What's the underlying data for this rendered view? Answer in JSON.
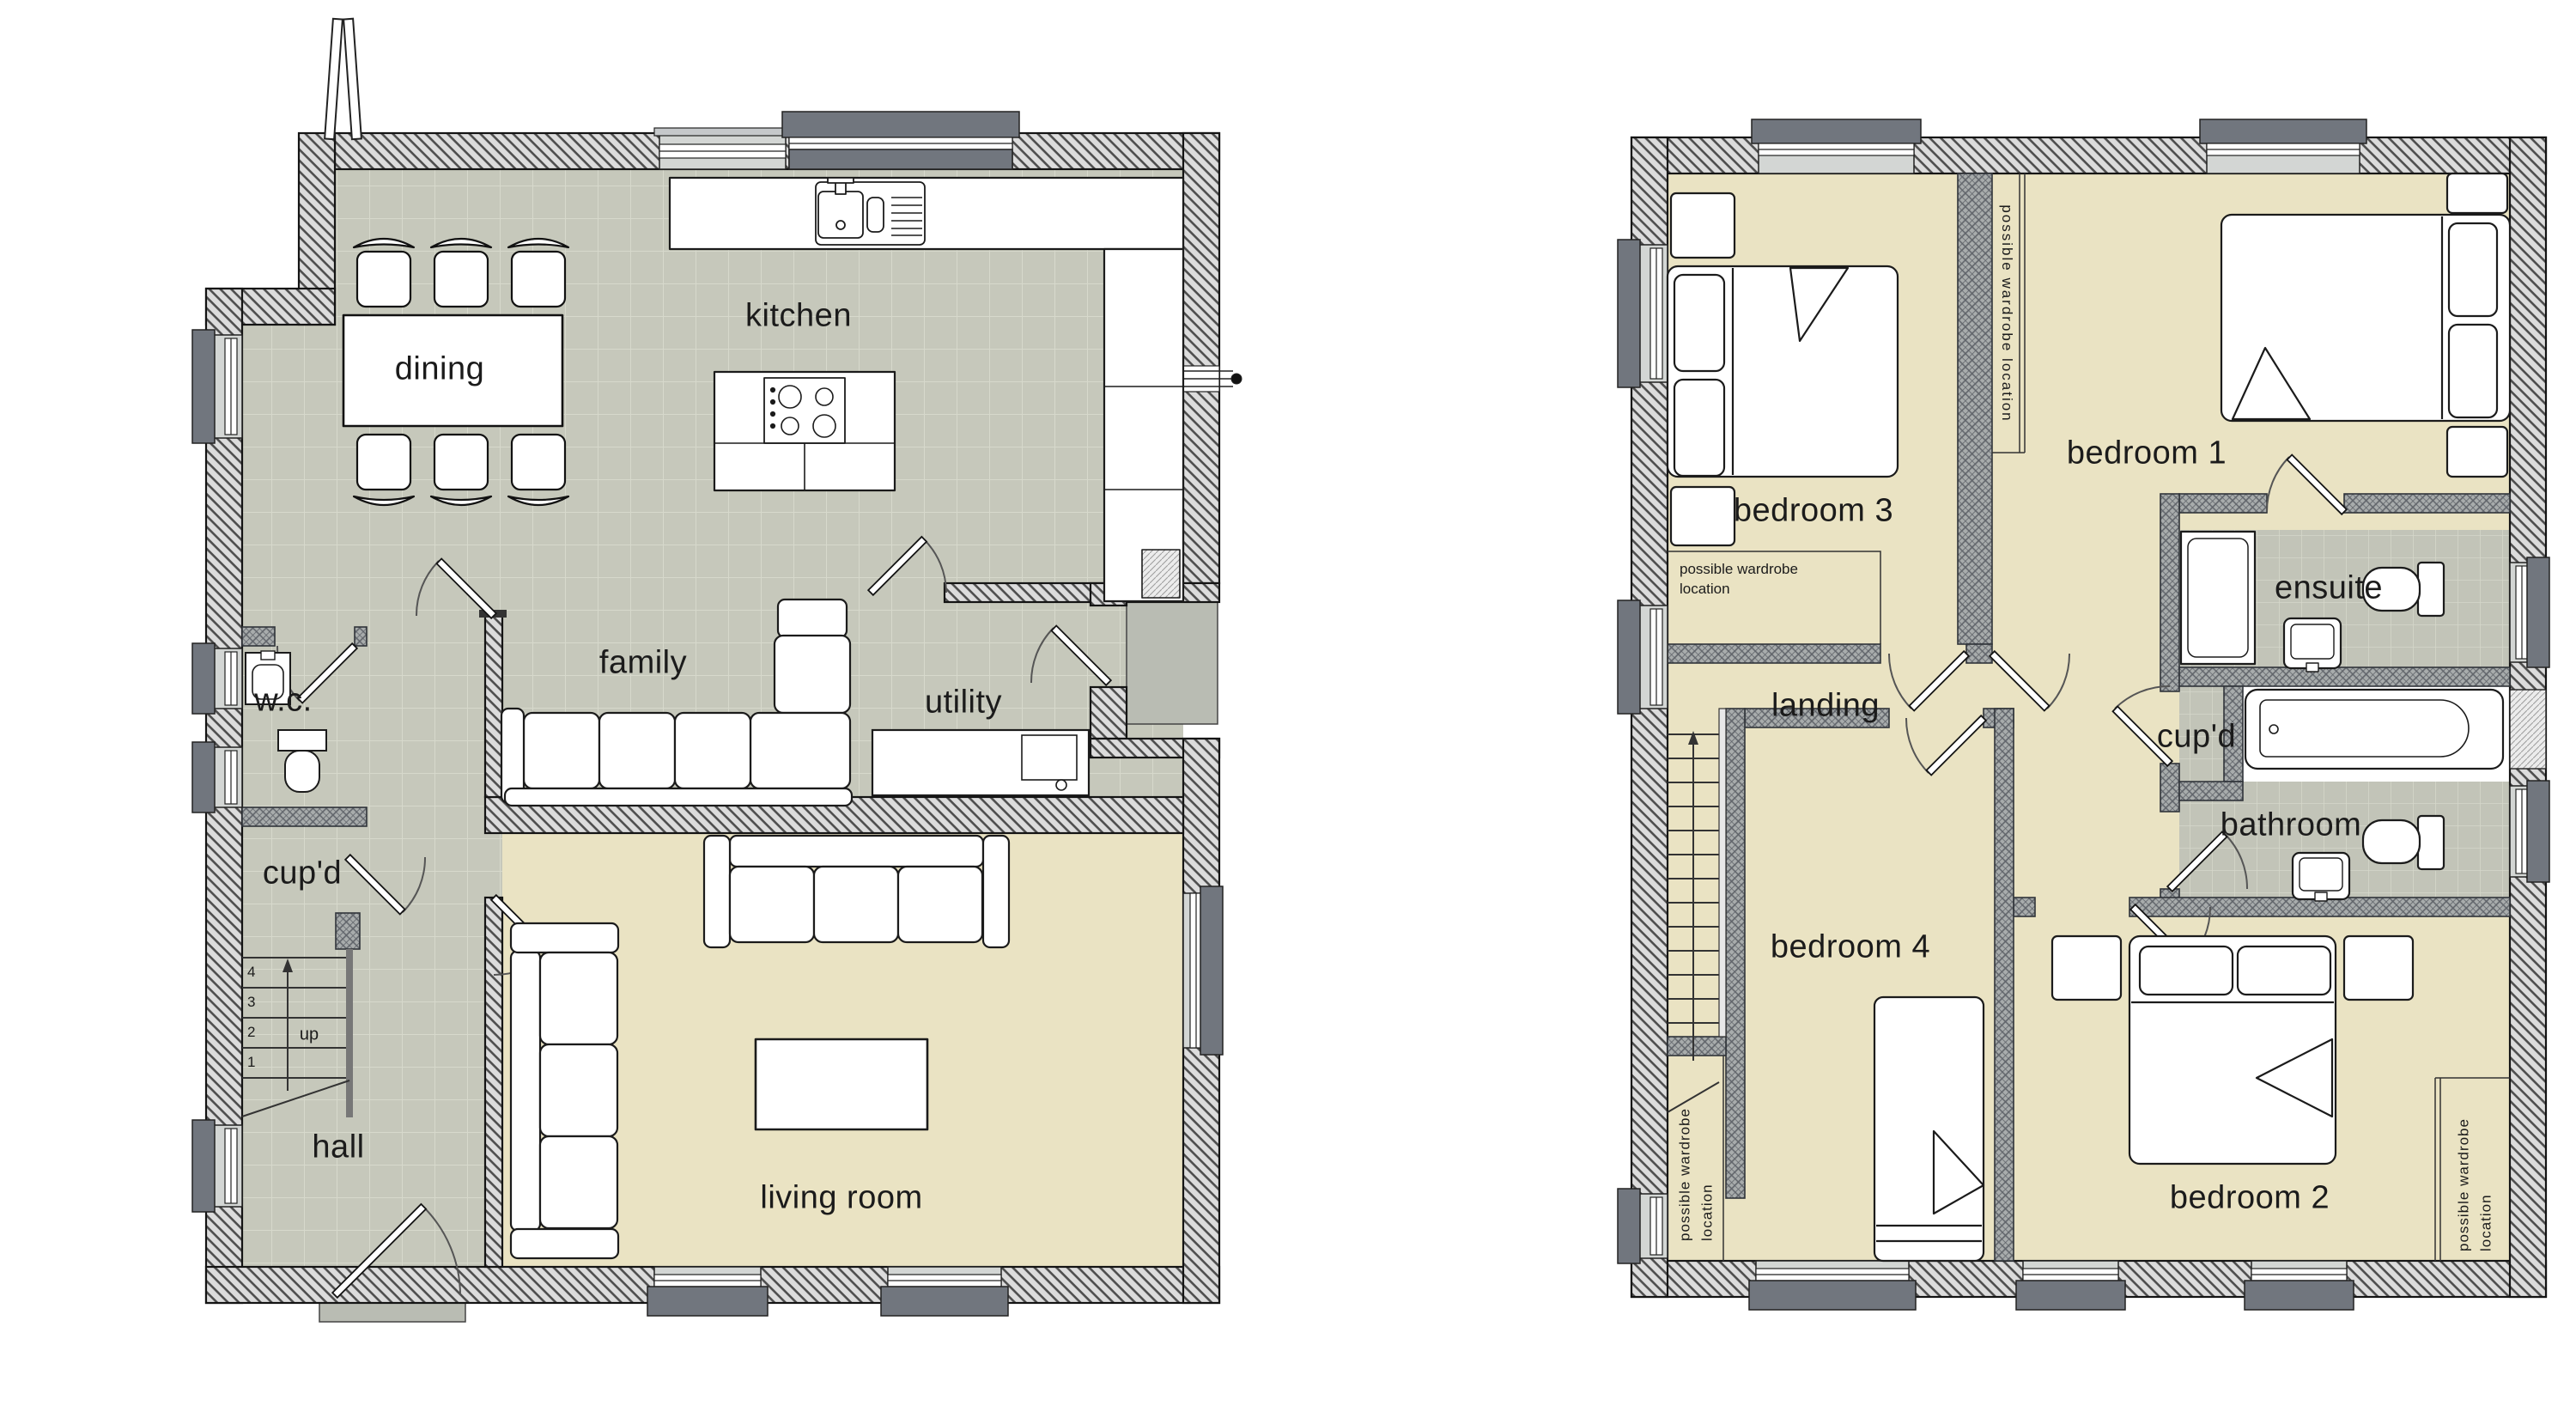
{
  "colors": {
    "background": "#ffffff",
    "tile_floor": "#c6c8bb",
    "tile_grid": "#d7d9cc",
    "carpet_floor": "#eae3c3",
    "exterior_wall_hatch_base": "#dcdcdc",
    "exterior_wall_hatch_line": "#4e4e4e",
    "interior_wall_base": "#a8acac",
    "window_block": "#71767e",
    "porch_slab": "#b9bcb3",
    "outline": "#1b1b1b"
  },
  "ground_floor": {
    "labels": {
      "dining": "dining",
      "kitchen": "kitchen",
      "family": "family",
      "utility": "utility",
      "wc": "w.c.",
      "cupboard": "cup'd",
      "hall": "hall",
      "living_room": "living room"
    },
    "stairs": {
      "up_label": "up",
      "steps": [
        "4",
        "3",
        "2",
        "1"
      ]
    }
  },
  "first_floor": {
    "labels": {
      "bedroom_3": "bedroom 3",
      "bedroom_1": "bedroom 1",
      "landing": "landing",
      "ensuite": "ensuite",
      "cupboard": "cup'd",
      "bathroom": "bathroom",
      "bedroom_4": "bedroom 4",
      "bedroom_2": "bedroom 2"
    },
    "wardrobe_notes": {
      "bedroom_3_box": "possible wardrobe location",
      "bedroom_1_wall": "possible wardrobe location",
      "bedroom_4_wall": "possible wardrobe location",
      "bedroom_2_wall": "possible wardrobe location"
    }
  }
}
